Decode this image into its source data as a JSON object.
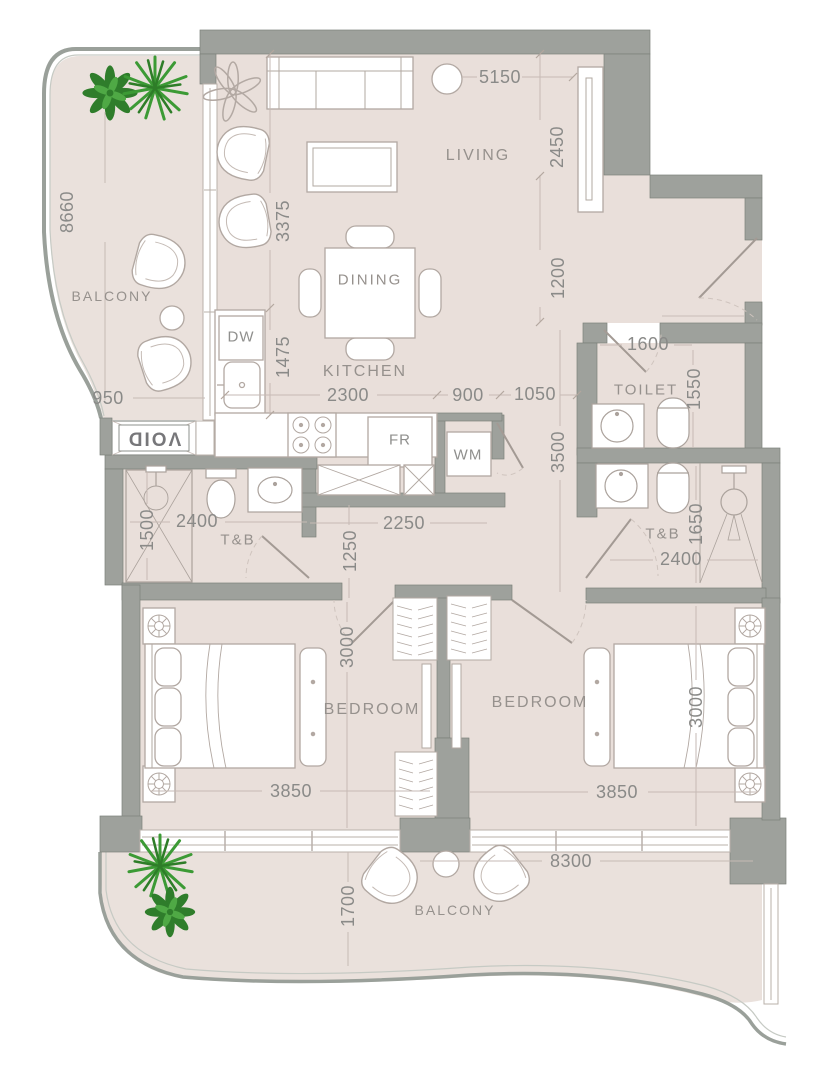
{
  "title": "2 Bedroom Apartment Floor Plan",
  "rooms": {
    "living": {
      "label": "LIVING"
    },
    "dining": {
      "label": "DINING"
    },
    "kitchen": {
      "label": "KITCHEN"
    },
    "toilet": {
      "label": "TOILET"
    },
    "tb_left": {
      "label": "T&B"
    },
    "tb_right": {
      "label": "T&B"
    },
    "bedroom_left": {
      "label": "BEDROOM"
    },
    "bedroom_right": {
      "label": "BEDROOM"
    },
    "balcony_top": {
      "label": "BALCONY"
    },
    "balcony_bottom": {
      "label": "BALCONY"
    },
    "void": {
      "label": "VOID"
    }
  },
  "appliances": {
    "dishwasher": "DW",
    "fridge": "FR",
    "washing_machine": "WM"
  },
  "dimensions": {
    "living_width": "5150",
    "living_depth_upper": "2450",
    "living_depth_lower": "1200",
    "balcony_left_length": "8660",
    "living_left_depth": "3375",
    "kitchen_counter_depth": "1475",
    "kitchen_width": "2300",
    "passage_width": "900",
    "entry_width": "1050",
    "toilet_width": "1600",
    "toilet_depth": "1550",
    "corridor_length": "3500",
    "balcony_neck": "950",
    "tb_left_width": "2400",
    "tb_left_depth": "1500",
    "hall_width": "2250",
    "hall_depth": "1250",
    "tb_right_depth": "1650",
    "tb_right_width": "2400",
    "bedroom_left_depth": "3000",
    "bedroom_left_width": "3850",
    "bedroom_right_width": "3850",
    "bedroom_right_depth": "3000",
    "balcony_bottom_width": "8300",
    "balcony_bottom_depth": "1700"
  },
  "colors": {
    "floor": "#e9dfda",
    "balcony_floor": "#eae1dc",
    "wall": "#9ea19c",
    "plant_green": "#3c9a35",
    "dim_text": "#8a8a88"
  }
}
